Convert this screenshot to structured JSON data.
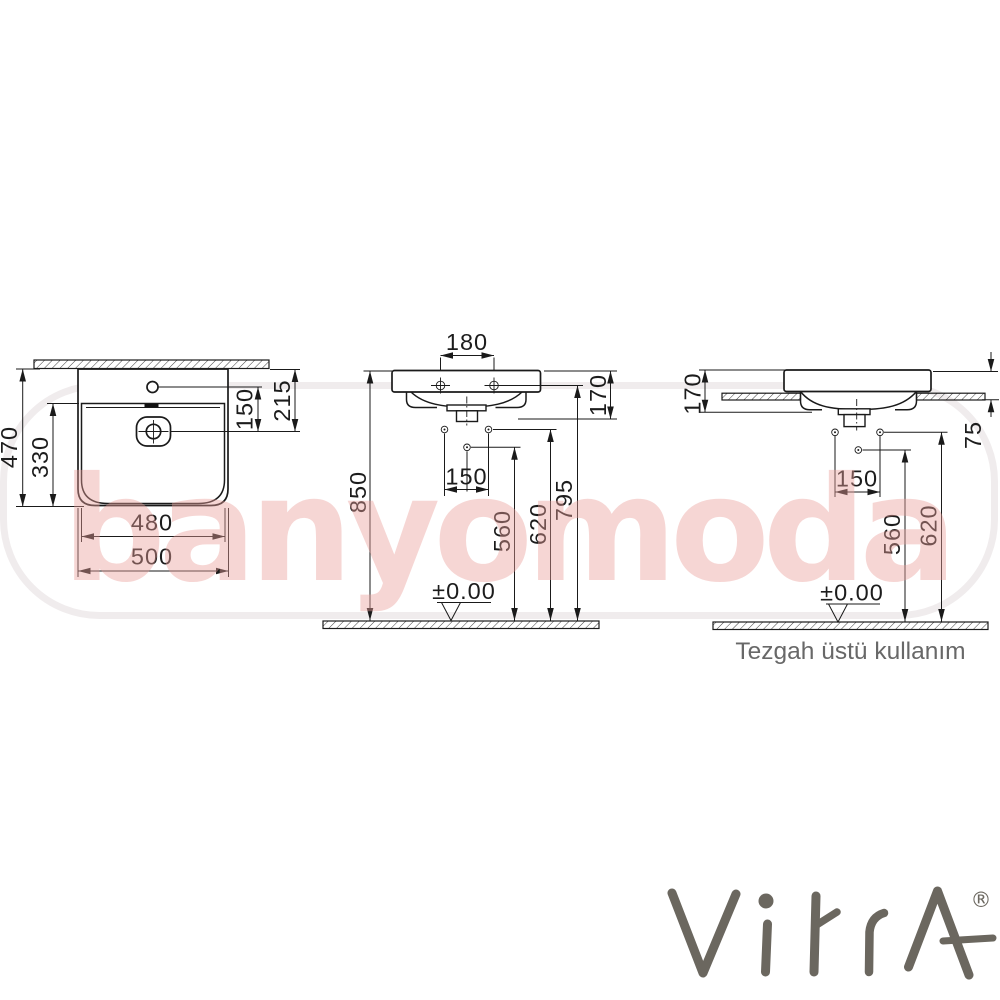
{
  "watermark": {
    "text": "banyomoda"
  },
  "brand": {
    "name": "VitrA",
    "registered_mark": "®"
  },
  "views": {
    "top_view": {
      "dims": {
        "overall_depth": "470",
        "bowl_depth": "330",
        "tap_to_drain": "150",
        "rim_to_drain": "215",
        "bowl_width": "480",
        "overall_width": "500"
      }
    },
    "front_view": {
      "dims": {
        "tap_hole_spacing": "180",
        "body_height": "170",
        "floor_to_rim": "850",
        "fixing_hole_spacing": "150",
        "floor_to_lower_hole": "560",
        "floor_to_fixing_holes": "620",
        "floor_to_tap_deck": "795",
        "floor_datum": "±0.00"
      }
    },
    "side_view": {
      "caption": "Tezgah üstü kullanım",
      "dims": {
        "body_height": "170",
        "rim_above_counter": "75",
        "fixing_hole_spacing": "150",
        "floor_to_lower_hole": "560",
        "floor_to_fixing_holes": "620",
        "floor_datum": "±0.00"
      }
    }
  }
}
